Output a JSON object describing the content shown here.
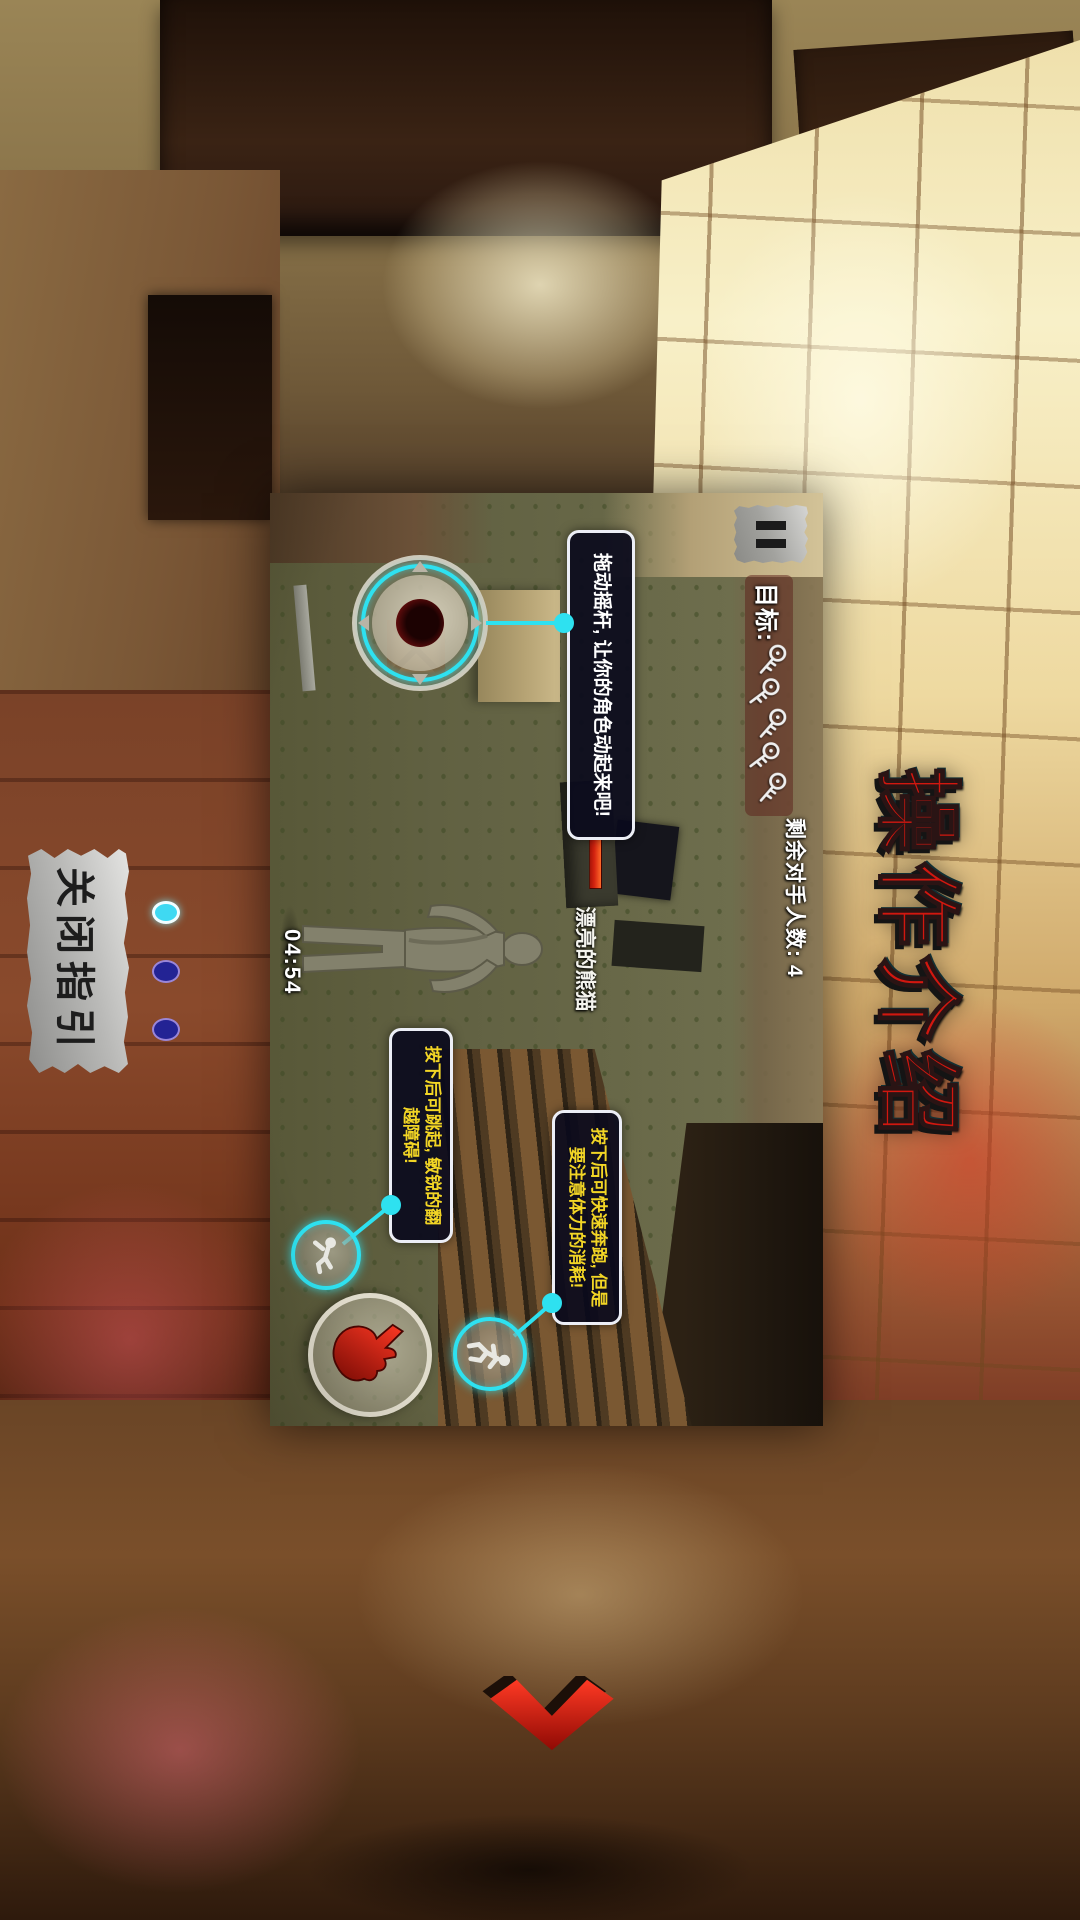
{
  "overlay": {
    "title": "操作介绍",
    "close_button": "关闭指引",
    "pager": {
      "count": 3,
      "active": 0
    },
    "next_arrow_icon": "red-chevron-down"
  },
  "screenshot": {
    "rotation": "landscape-rotated-90deg-clockwise",
    "hud": {
      "pause_icon": "pause",
      "objective_label": "目标:",
      "objective_keys_count": 5,
      "key_icon": "key",
      "opponents_remaining": "剩余对手人数: 4",
      "timer": "04:54",
      "character_health_bar": "red",
      "character_name": "漂亮的熊猫"
    },
    "tooltips": {
      "joystick": "拖动摇杆, 让你的角色动起来吧!",
      "jump": "按下后可跳起, 敏锐的翻越障碍!",
      "run": "按下后可快速奔跑, 但是要注意体力的消耗!"
    },
    "controls": {
      "joystick": "virtual-joystick",
      "jump_button_icon": "jumping-figure",
      "run_button_icon": "running-figure",
      "attack_button_icon": "red-hand-fist"
    }
  },
  "colors": {
    "accent_cyan": "#2ee1f0",
    "tooltip_text_white": "#ffffff",
    "tooltip_text_yellow": "#f2d525",
    "title_red": "#d2170f",
    "dot_active": "#3fd9f2",
    "dot_inactive": "#232394",
    "health_bar_red": "#d42410"
  }
}
